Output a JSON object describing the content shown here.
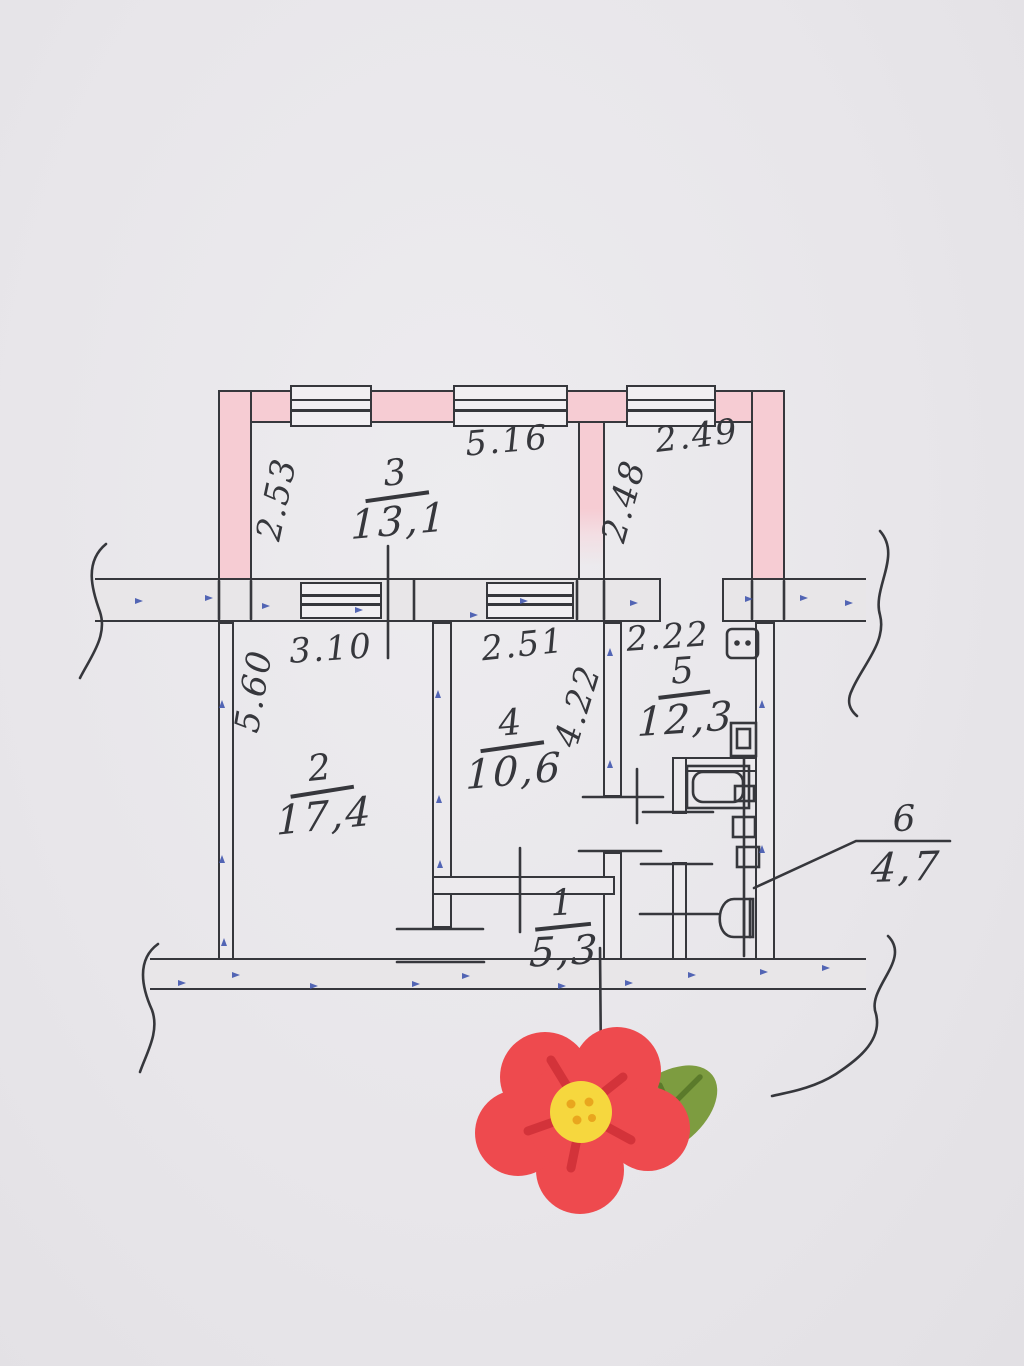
{
  "scene": {
    "kind": "hand-drawn apartment floor plan photo",
    "sticker": "red flower with green leaf"
  },
  "colors": {
    "paper": "#e9e7ea",
    "ink": "#36373c",
    "wall_pink": "#f6ccd3",
    "band": "#e8e6e8",
    "dots_blue": "#4156ae",
    "flower_red": "#ee4a4e",
    "flower_dark": "#d3333a",
    "flower_center": "#f6d73e",
    "flower_dots": "#e9a61e",
    "leaf_green": "#7d9c40",
    "leaf_dark": "#5b7a2b"
  },
  "rooms": {
    "r1": {
      "num": "1",
      "area": "5,3"
    },
    "r2": {
      "num": "2",
      "area": "17,4"
    },
    "r3": {
      "num": "3",
      "area": "13,1"
    },
    "r4": {
      "num": "4",
      "area": "10,6"
    },
    "r5": {
      "num": "5",
      "area": "12,3"
    },
    "r6": {
      "num": "6",
      "area": "4,7"
    }
  },
  "dims": {
    "room3_top": "5.16",
    "upper_right_top": "2.49",
    "room3_left": "2.53",
    "room3_right": "2.48",
    "room2_top": "3.10",
    "room4_top": "2.51",
    "room5_top": "2.22",
    "room2_left": "5.60",
    "room4_right": "4.22"
  }
}
